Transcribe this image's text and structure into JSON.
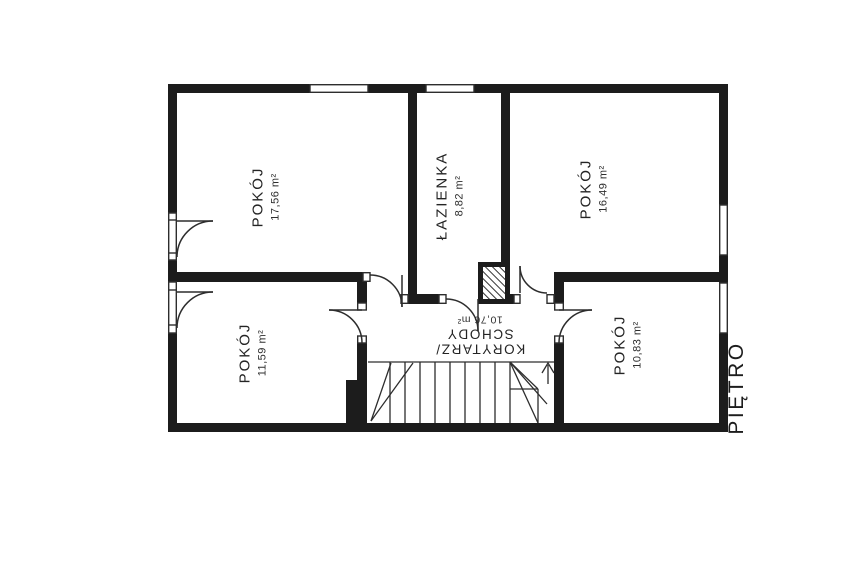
{
  "plan": {
    "floor_label": "PIĘTRO",
    "rooms": [
      {
        "id": "pokoj-top-left",
        "name": "POKÓJ",
        "area": "17,56 m²"
      },
      {
        "id": "lazienka",
        "name": "ŁAZIENKA",
        "area": "8,82 m²"
      },
      {
        "id": "pokoj-top-right",
        "name": "POKÓJ",
        "area": "16,49 m²"
      },
      {
        "id": "pokoj-bottom-left",
        "name": "POKÓJ",
        "area": "11,59 m²"
      },
      {
        "id": "korytarz-schody",
        "name": "KORYTARZ/",
        "name2": "SCHODY",
        "area": "10,76 m²"
      },
      {
        "id": "pokoj-bottom-right",
        "name": "POKÓJ",
        "area": "10,83 m²"
      }
    ],
    "colors": {
      "walls": "#1c1c1c",
      "thin_lines": "#2d2d2d",
      "text": "#242424",
      "background": "#ffffff"
    }
  }
}
